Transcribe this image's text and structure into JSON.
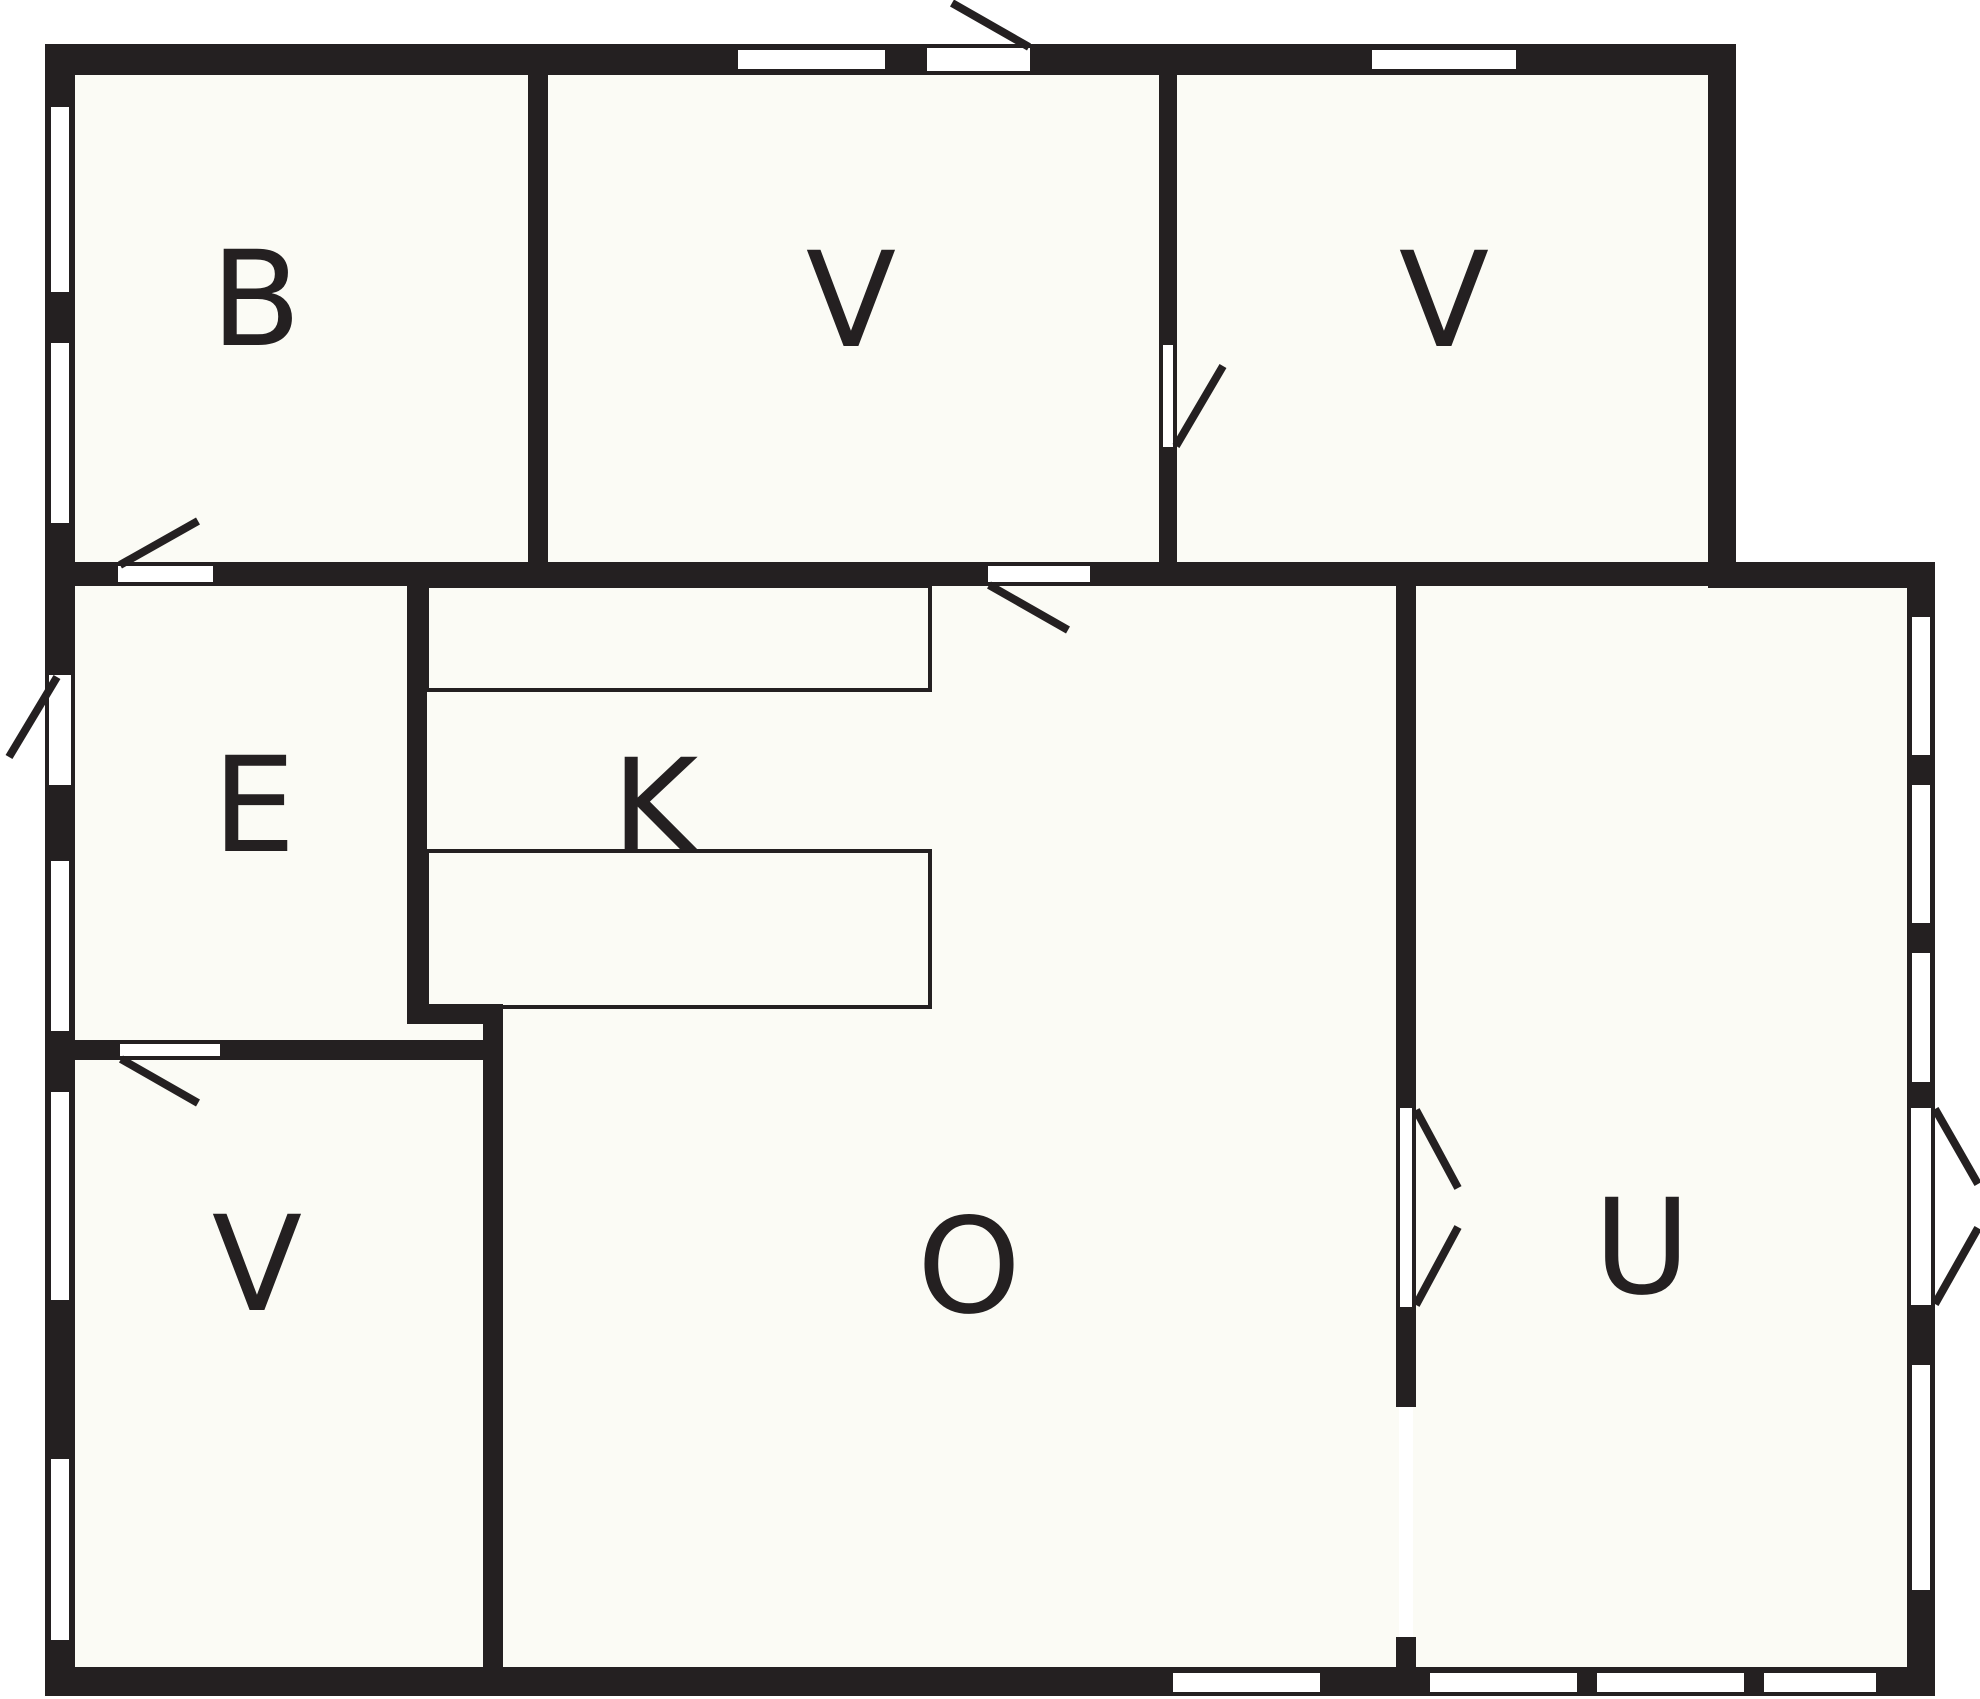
{
  "title": "Floor plan drawing",
  "canvas": {
    "width": 1980,
    "height": 1699,
    "background": "#ffffff",
    "floor_fill": "#fbfbf5",
    "wall_color": "#242021",
    "cut_color": "#ffffff",
    "label_color": "#242021",
    "label_font_size": 132,
    "leaf_stroke": 8,
    "counter_stroke": 4
  },
  "room_labels": [
    {
      "text": "B",
      "x": 256,
      "y": 300,
      "room": "bedroom-top-left"
    },
    {
      "text": "V",
      "x": 851,
      "y": 301,
      "room": "room-top-middle"
    },
    {
      "text": "V",
      "x": 1444,
      "y": 301,
      "room": "room-top-right"
    },
    {
      "text": "E",
      "x": 254,
      "y": 806,
      "room": "entrance-hall"
    },
    {
      "text": "K",
      "x": 655,
      "y": 808,
      "room": "kitchen"
    },
    {
      "text": "V",
      "x": 257,
      "y": 1265,
      "room": "room-bottom-left"
    },
    {
      "text": "O",
      "x": 969,
      "y": 1267,
      "room": "living-room"
    },
    {
      "text": "U",
      "x": 1642,
      "y": 1248,
      "room": "outbuilding-room"
    }
  ],
  "floors": [
    {
      "name": "floor-main-block",
      "x": 75,
      "y": 75,
      "w": 1633,
      "h": 1592
    },
    {
      "name": "floor-u-block",
      "x": 1416,
      "y": 588,
      "w": 491,
      "h": 1079
    }
  ],
  "walls": [
    {
      "name": "top-wall",
      "x": 45,
      "y": 44,
      "w": 1691,
      "h": 31
    },
    {
      "name": "left-wall",
      "x": 45,
      "y": 44,
      "w": 30,
      "h": 1652
    },
    {
      "name": "bottom-wall",
      "x": 45,
      "y": 1667,
      "w": 1890,
      "h": 29
    },
    {
      "name": "right-wall-upper",
      "x": 1708,
      "y": 44,
      "w": 28,
      "h": 544
    },
    {
      "name": "u-top-wall",
      "x": 1708,
      "y": 562,
      "w": 227,
      "h": 26
    },
    {
      "name": "u-right-wall",
      "x": 1907,
      "y": 562,
      "w": 28,
      "h": 1134
    },
    {
      "name": "mid-band-wall-1",
      "x": 75,
      "y": 562,
      "w": 43,
      "h": 24
    },
    {
      "name": "mid-band-wall-2",
      "x": 213,
      "y": 562,
      "w": 775,
      "h": 24
    },
    {
      "name": "mid-band-wall-3",
      "x": 1090,
      "y": 562,
      "w": 618,
      "h": 24
    },
    {
      "name": "b-v-divider",
      "x": 528,
      "y": 75,
      "w": 20,
      "h": 487
    },
    {
      "name": "v-v-divider-top",
      "x": 1159,
      "y": 75,
      "w": 18,
      "h": 270
    },
    {
      "name": "v-v-divider-stub",
      "x": 1159,
      "y": 447,
      "w": 18,
      "h": 115
    },
    {
      "name": "e-k-wall",
      "x": 407,
      "y": 586,
      "w": 20,
      "h": 438
    },
    {
      "name": "k-corner-stub",
      "x": 407,
      "y": 1004,
      "w": 96,
      "h": 20
    },
    {
      "name": "v-o-wall",
      "x": 483,
      "y": 1004,
      "w": 20,
      "h": 663
    },
    {
      "name": "e-v-wall-left",
      "x": 75,
      "y": 1040,
      "w": 45,
      "h": 20
    },
    {
      "name": "e-v-wall-right",
      "x": 220,
      "y": 1040,
      "w": 283,
      "h": 20
    },
    {
      "name": "o-u-wall-top",
      "x": 1396,
      "y": 586,
      "w": 20,
      "h": 522
    },
    {
      "name": "o-u-wall-mid",
      "x": 1396,
      "y": 1307,
      "w": 20,
      "h": 100
    },
    {
      "name": "o-u-wall-bottom",
      "x": 1396,
      "y": 1637,
      "w": 20,
      "h": 30
    }
  ],
  "door_cuts": [
    {
      "name": "main-entrance-opening",
      "x": 927,
      "y": 44,
      "w": 103,
      "h": 31
    },
    {
      "name": "b-door-opening",
      "x": 118,
      "y": 562,
      "w": 95,
      "h": 24
    },
    {
      "name": "v-mid-door-opening",
      "x": 988,
      "y": 562,
      "w": 102,
      "h": 24
    },
    {
      "name": "e-entrance-opening",
      "x": 45,
      "y": 675,
      "w": 30,
      "h": 110
    },
    {
      "name": "e-v-door-opening",
      "x": 120,
      "y": 1040,
      "w": 100,
      "h": 20
    },
    {
      "name": "v-v-door-opening",
      "x": 1159,
      "y": 345,
      "w": 18,
      "h": 102
    },
    {
      "name": "o-u-double-door-opening",
      "x": 1396,
      "y": 1108,
      "w": 20,
      "h": 199
    },
    {
      "name": "u-terrace-door-opening",
      "x": 1907,
      "y": 1108,
      "w": 28,
      "h": 197
    },
    {
      "name": "o-u-glass-panel",
      "x": 1399,
      "y": 1407,
      "w": 14,
      "h": 230
    }
  ],
  "windows": [
    {
      "name": "window-b-1",
      "x": 51,
      "y": 107,
      "w": 18,
      "h": 185
    },
    {
      "name": "window-b-2",
      "x": 51,
      "y": 343,
      "w": 18,
      "h": 180
    },
    {
      "name": "window-e",
      "x": 51,
      "y": 861,
      "w": 18,
      "h": 170
    },
    {
      "name": "window-v-low-1",
      "x": 51,
      "y": 1092,
      "w": 18,
      "h": 208
    },
    {
      "name": "window-v-low-2",
      "x": 51,
      "y": 1459,
      "w": 18,
      "h": 181
    },
    {
      "name": "window-top-vmid",
      "x": 738,
      "y": 50,
      "w": 147,
      "h": 19
    },
    {
      "name": "window-top-vright",
      "x": 1372,
      "y": 50,
      "w": 144,
      "h": 19
    },
    {
      "name": "window-bottom-o",
      "x": 1173,
      "y": 1673,
      "w": 147,
      "h": 19
    },
    {
      "name": "window-bottom-u1",
      "x": 1430,
      "y": 1673,
      "w": 147,
      "h": 19
    },
    {
      "name": "window-bottom-u2",
      "x": 1597,
      "y": 1673,
      "w": 147,
      "h": 19
    },
    {
      "name": "window-bottom-u3",
      "x": 1764,
      "y": 1673,
      "w": 112,
      "h": 19
    },
    {
      "name": "window-u-right-1",
      "x": 1912,
      "y": 617,
      "w": 18,
      "h": 138
    },
    {
      "name": "window-u-right-2",
      "x": 1912,
      "y": 785,
      "w": 18,
      "h": 138
    },
    {
      "name": "window-u-right-3",
      "x": 1912,
      "y": 953,
      "w": 18,
      "h": 129
    },
    {
      "name": "window-u-right-4",
      "x": 1912,
      "y": 1365,
      "w": 18,
      "h": 225
    }
  ],
  "jambs": [
    {
      "name": "jamb",
      "x": 927,
      "y": 44,
      "w": 103,
      "h": 4
    },
    {
      "name": "jamb",
      "x": 927,
      "y": 71,
      "w": 103,
      "h": 4
    },
    {
      "name": "jamb",
      "x": 118,
      "y": 562,
      "w": 95,
      "h": 4
    },
    {
      "name": "jamb",
      "x": 118,
      "y": 582,
      "w": 95,
      "h": 4
    },
    {
      "name": "jamb",
      "x": 988,
      "y": 562,
      "w": 102,
      "h": 4
    },
    {
      "name": "jamb",
      "x": 988,
      "y": 582,
      "w": 102,
      "h": 4
    },
    {
      "name": "jamb",
      "x": 45,
      "y": 675,
      "w": 4,
      "h": 110
    },
    {
      "name": "jamb",
      "x": 71,
      "y": 675,
      "w": 4,
      "h": 110
    },
    {
      "name": "jamb",
      "x": 120,
      "y": 1040,
      "w": 100,
      "h": 4
    },
    {
      "name": "jamb",
      "x": 120,
      "y": 1056,
      "w": 100,
      "h": 4
    },
    {
      "name": "jamb",
      "x": 1159,
      "y": 345,
      "w": 4,
      "h": 102
    },
    {
      "name": "jamb",
      "x": 1173,
      "y": 345,
      "w": 4,
      "h": 102
    },
    {
      "name": "jamb",
      "x": 1396,
      "y": 1108,
      "w": 4,
      "h": 199
    },
    {
      "name": "jamb",
      "x": 1412,
      "y": 1108,
      "w": 4,
      "h": 199
    },
    {
      "name": "jamb",
      "x": 1907,
      "y": 1108,
      "w": 4,
      "h": 197
    },
    {
      "name": "jamb",
      "x": 1931,
      "y": 1108,
      "w": 4,
      "h": 197
    }
  ],
  "counters": [
    {
      "name": "kitchen-counter-upper",
      "x": 427,
      "y": 586,
      "w": 503,
      "h": 104
    },
    {
      "name": "kitchen-counter-lower",
      "x": 427,
      "y": 851,
      "w": 503,
      "h": 156
    }
  ],
  "door_leaves": [
    {
      "name": "main-entrance-leaf",
      "x1": 952,
      "y1": 3,
      "x2": 1029,
      "y2": 47
    },
    {
      "name": "b-door-leaf",
      "x1": 120,
      "y1": 565,
      "x2": 198,
      "y2": 521
    },
    {
      "name": "e-entrance-leaf",
      "x1": 57,
      "y1": 677,
      "x2": 9,
      "y2": 757
    },
    {
      "name": "v-mid-door-leaf",
      "x1": 989,
      "y1": 585,
      "x2": 1068,
      "y2": 630
    },
    {
      "name": "v-v-door-leaf",
      "x1": 1176,
      "y1": 446,
      "x2": 1223,
      "y2": 366
    },
    {
      "name": "e-v-door-leaf",
      "x1": 121,
      "y1": 1059,
      "x2": 198,
      "y2": 1103
    },
    {
      "name": "o-u-door-leaf-upper",
      "x1": 1416,
      "y1": 1110,
      "x2": 1458,
      "y2": 1188
    },
    {
      "name": "o-u-door-leaf-lower",
      "x1": 1416,
      "y1": 1305,
      "x2": 1458,
      "y2": 1227
    },
    {
      "name": "terrace-leaf-upper",
      "x1": 1935,
      "y1": 1109,
      "x2": 1978,
      "y2": 1184
    },
    {
      "name": "terrace-leaf-lower",
      "x1": 1935,
      "y1": 1304,
      "x2": 1978,
      "y2": 1228
    }
  ]
}
